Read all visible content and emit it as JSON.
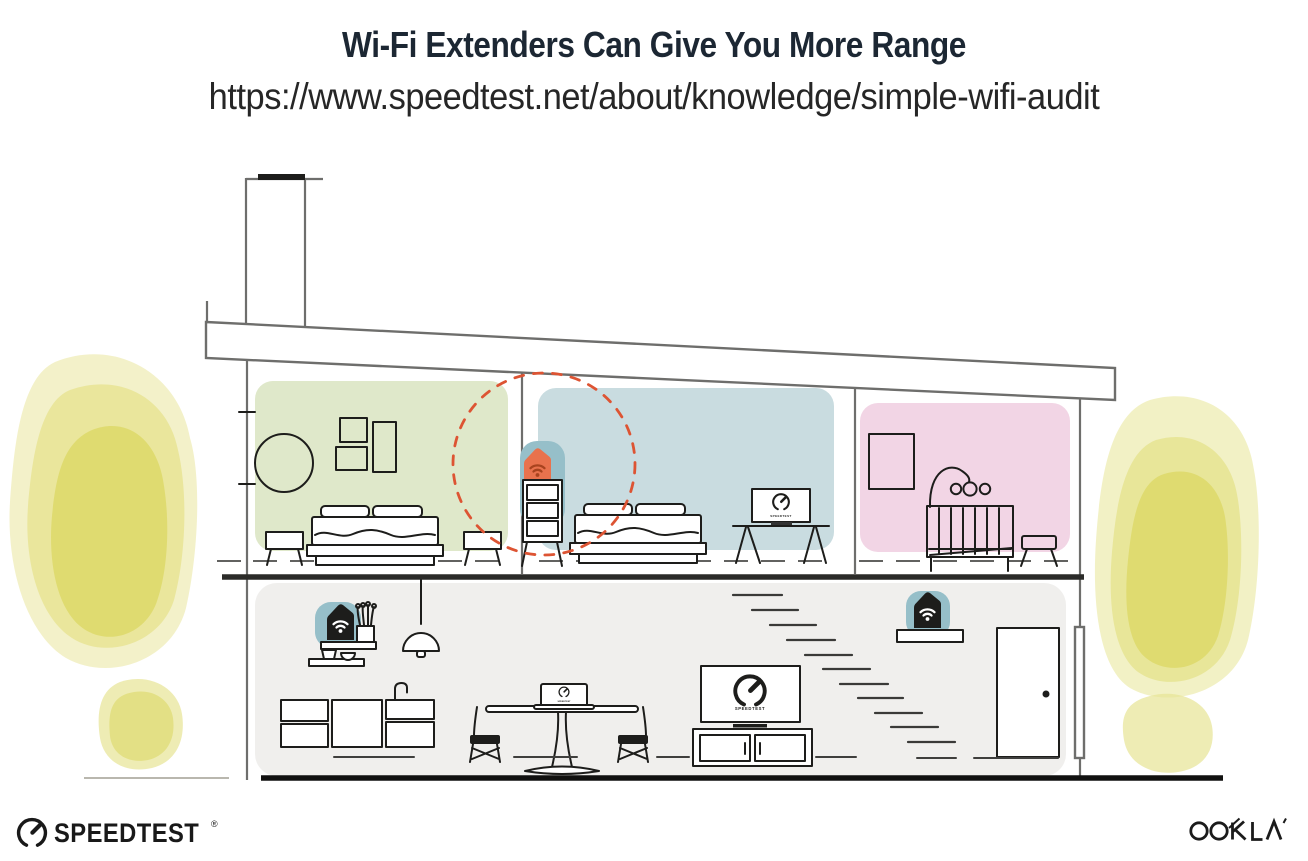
{
  "header": {
    "title": "Wi-Fi Extenders Can Give You More Range",
    "url": "https://www.speedtest.net/about/knowledge/simple-wifi-audit"
  },
  "illustration": {
    "bedroom_tv_label": "SPEEDTEST",
    "livingroom_tv_label": "SPEEDTEST",
    "laptop_label": "SPEEDTEST"
  },
  "footer": {
    "speedtest_wordmark": "SPEEDTEST",
    "speedtest_reg": "®",
    "ookla_wordmark": "OOKLA"
  },
  "icons": {
    "wifi-icon": "three arcs + dot",
    "speedtest-gauge-icon": "open circle with needle",
    "door-knob": "solid dot"
  },
  "colors": {
    "title-text": "#1c2733",
    "ink": "#1d1d1b",
    "line-gray": "#6e6e6c",
    "room-green": "#dfe8ca",
    "room-blue": "#c9dce0",
    "room-pink": "#f2d5e5",
    "floor-gray": "#f0efed",
    "extender-teal": "#96bfc9",
    "extender-orange": "#e8724d",
    "wifi-orange-dark": "#a8431f",
    "dashed-circle": "#dd5433",
    "wc-light": "#f0eebb",
    "wc-mid": "#e7e494",
    "wc-core": "#dcd865"
  }
}
